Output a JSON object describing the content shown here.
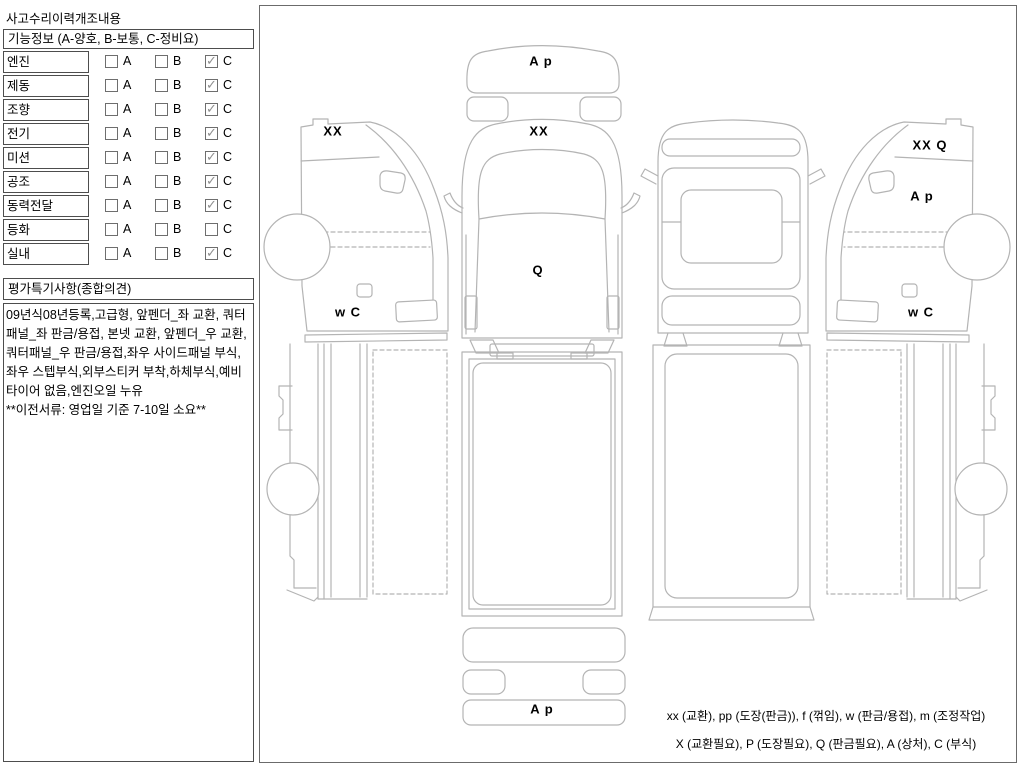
{
  "panel": {
    "title": "사고수리이력개조내용",
    "header": "기능정보 (A-양호, B-보통, C-정비요)",
    "grades": [
      "A",
      "B",
      "C"
    ],
    "rows": [
      {
        "label": "엔진",
        "checked": "C"
      },
      {
        "label": "제동",
        "checked": "C"
      },
      {
        "label": "조향",
        "checked": "C"
      },
      {
        "label": "전기",
        "checked": "C"
      },
      {
        "label": "미션",
        "checked": "C"
      },
      {
        "label": "공조",
        "checked": "C"
      },
      {
        "label": "동력전달",
        "checked": "C"
      },
      {
        "label": "등화",
        "checked": ""
      },
      {
        "label": "실내",
        "checked": "C"
      }
    ],
    "opinion_header": "평가특기사항(종합의견)",
    "opinion_text": "09년식08년등록,고급형, 앞펜더_좌 교환, 쿼터패널_좌 판금/용접, 본넷 교환, 앞펜더_우 교환, 쿼터패널_우 판금/용접,좌우 사이드패널 부식,좌우 스텝부식,외부스티커 부착,하체부식,예비타이어 없음,엔진오일 누유\n**이전서류: 영업일 기준 7-10일 소요**"
  },
  "diagram": {
    "line_color": "#b4b4b4",
    "border_color": "#6b6b6b",
    "markings": [
      {
        "id": "left-side-roof",
        "text": "XX",
        "x": 333,
        "y": 131
      },
      {
        "id": "left-side-lower",
        "text": "w C",
        "x": 348,
        "y": 312
      },
      {
        "id": "front-bumper",
        "text": "A p",
        "x": 541,
        "y": 61
      },
      {
        "id": "front-roof",
        "text": "XX",
        "x": 539,
        "y": 131
      },
      {
        "id": "front-panel",
        "text": "Q",
        "x": 538,
        "y": 270
      },
      {
        "id": "rear-bumper",
        "text": "A p",
        "x": 542,
        "y": 709
      },
      {
        "id": "right-side-roof",
        "text": "XX Q",
        "x": 930,
        "y": 145
      },
      {
        "id": "right-side-door",
        "text": "A p",
        "x": 922,
        "y": 196
      },
      {
        "id": "right-side-lower",
        "text": "w C",
        "x": 921,
        "y": 312
      }
    ],
    "legend_line1": "xx (교환), pp (도장(판금)), f (꺾임), w (판금/용접), m (조정작업)",
    "legend_line2": "X (교환필요), P (도장필요), Q (판금필요), A (상처), C (부식)"
  }
}
